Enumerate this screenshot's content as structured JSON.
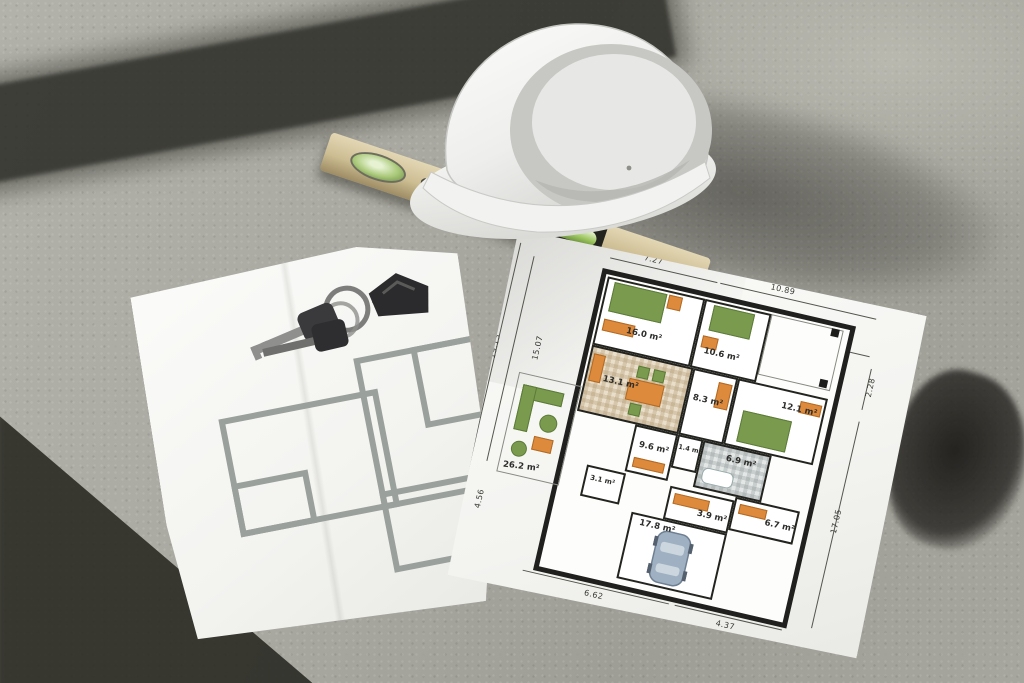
{
  "scene": {
    "objects": {
      "hard_hat": "white safety helmet",
      "spirit_level": "wooden spirit level with green bubble vials",
      "keys": "house keys on ring with house-shaped fob",
      "sketch_paper": "paper with simple gray floor-plan sketch",
      "plan_paper": "paper with detailed colored floor plan",
      "floor": "sunlit concrete floor with diagonal shadows"
    },
    "colors": {
      "concrete": "#a8a8a0",
      "shadow": "#2e2e28",
      "paper": "#f6f6f4",
      "wall": "#20201e",
      "accent_orange": "#dd8a3c",
      "accent_green": "#7a9b4e",
      "floor_beige": "#e8deca",
      "floor_gray": "#e3e7e6",
      "car_blue": "#9fb0c2",
      "level_wood": "#cdbd93",
      "vial_green": "#9cc45e",
      "helmet_white": "#f1f1ef",
      "sketch_gray": "#9aa09c"
    }
  },
  "plan": {
    "rooms": [
      {
        "name": "bedroom-1",
        "area": "16.0 m²"
      },
      {
        "name": "bedroom-2",
        "area": "10.6 m²"
      },
      {
        "name": "dining-room",
        "area": "13.1 m²"
      },
      {
        "name": "hallway",
        "area": "8.3 m²"
      },
      {
        "name": "bedroom-3",
        "area": "12.1 m²"
      },
      {
        "name": "bathroom",
        "area": "6.9 m²"
      },
      {
        "name": "terrace",
        "area": "26.2 m²"
      },
      {
        "name": "hall",
        "area": "9.6 m²"
      },
      {
        "name": "wc",
        "area": "1.4 m²"
      },
      {
        "name": "storage",
        "area": "6.7 m²"
      },
      {
        "name": "vestibule",
        "area": "3.1 m²"
      },
      {
        "name": "utility",
        "area": "3.9 m²"
      },
      {
        "name": "garage",
        "area": "17.8 m²"
      }
    ],
    "dimensions": {
      "top_left_width": "7.27",
      "top_right_width": "10.89",
      "porch_width": "5.62",
      "right_top": "2.28",
      "right_side": "17.05",
      "left_outer": "19.13",
      "left_inner": "15.07",
      "bottom_left": "4.56",
      "bottom_mid": "6.62",
      "bottom_right": "4.37"
    }
  }
}
